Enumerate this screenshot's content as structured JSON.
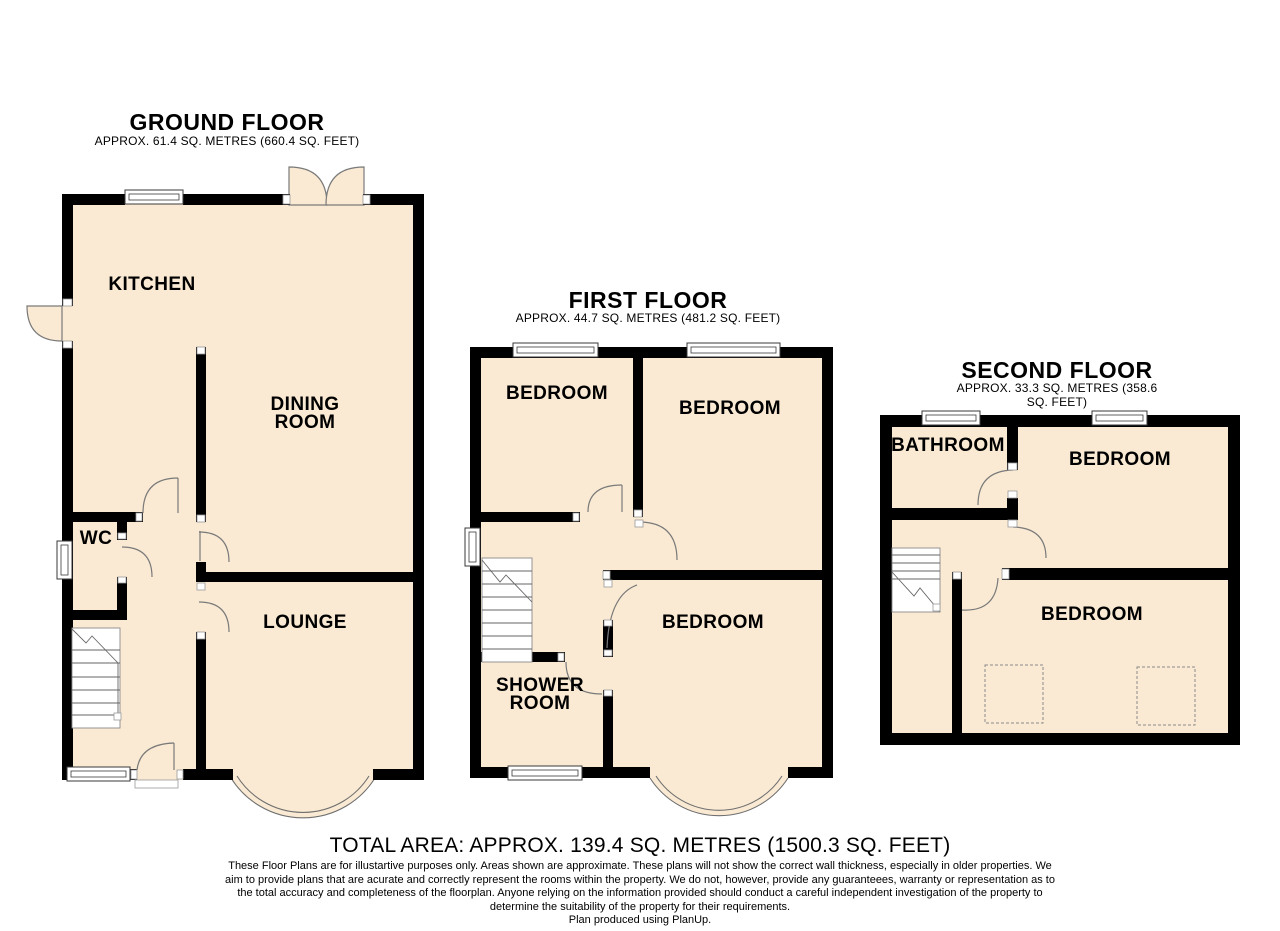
{
  "colors": {
    "floor_fill": "#faead3",
    "wall": "#000000",
    "detail_line": "#7a7a7a"
  },
  "floors": [
    {
      "title": "GROUND FLOOR",
      "area_line": "APPROX. 61.4 SQ. METRES (660.4 SQ. FEET)",
      "rooms": [
        {
          "label": "KITCHEN"
        },
        {
          "label": "DINING\nROOM"
        },
        {
          "label": "WC"
        },
        {
          "label": "LOUNGE"
        }
      ]
    },
    {
      "title": "FIRST FLOOR",
      "area_line": "APPROX. 44.7 SQ. METRES (481.2 SQ. FEET)",
      "rooms": [
        {
          "label": "BEDROOM"
        },
        {
          "label": "BEDROOM"
        },
        {
          "label": "BEDROOM"
        },
        {
          "label": "SHOWER\nROOM"
        }
      ]
    },
    {
      "title": "SECOND FLOOR",
      "area_line": "APPROX. 33.3 SQ. METRES (358.6 SQ. FEET)",
      "rooms": [
        {
          "label": "BATHROOM"
        },
        {
          "label": "BEDROOM"
        },
        {
          "label": "BEDROOM"
        }
      ]
    }
  ],
  "total_area_line": "TOTAL AREA: APPROX. 139.4 SQ. METRES (1500.3 SQ. FEET)",
  "disclaimer_lines": [
    "These Floor Plans are for illustartive purposes only. Areas shown are approximate. These plans will not show the correct wall thickness, especially in older properties. We",
    "aim to provide plans that are acurate and correctly represent the rooms within the property. We do not, however, provide any guaranteees, warranty or representation as to",
    "the total accuracy and completeness of the floorplan. Anyone relying on the information provided should conduct a careful independent investigation of the property to",
    "determine the suitability of the property for their requirements."
  ],
  "credit_line": "Plan produced using PlanUp."
}
